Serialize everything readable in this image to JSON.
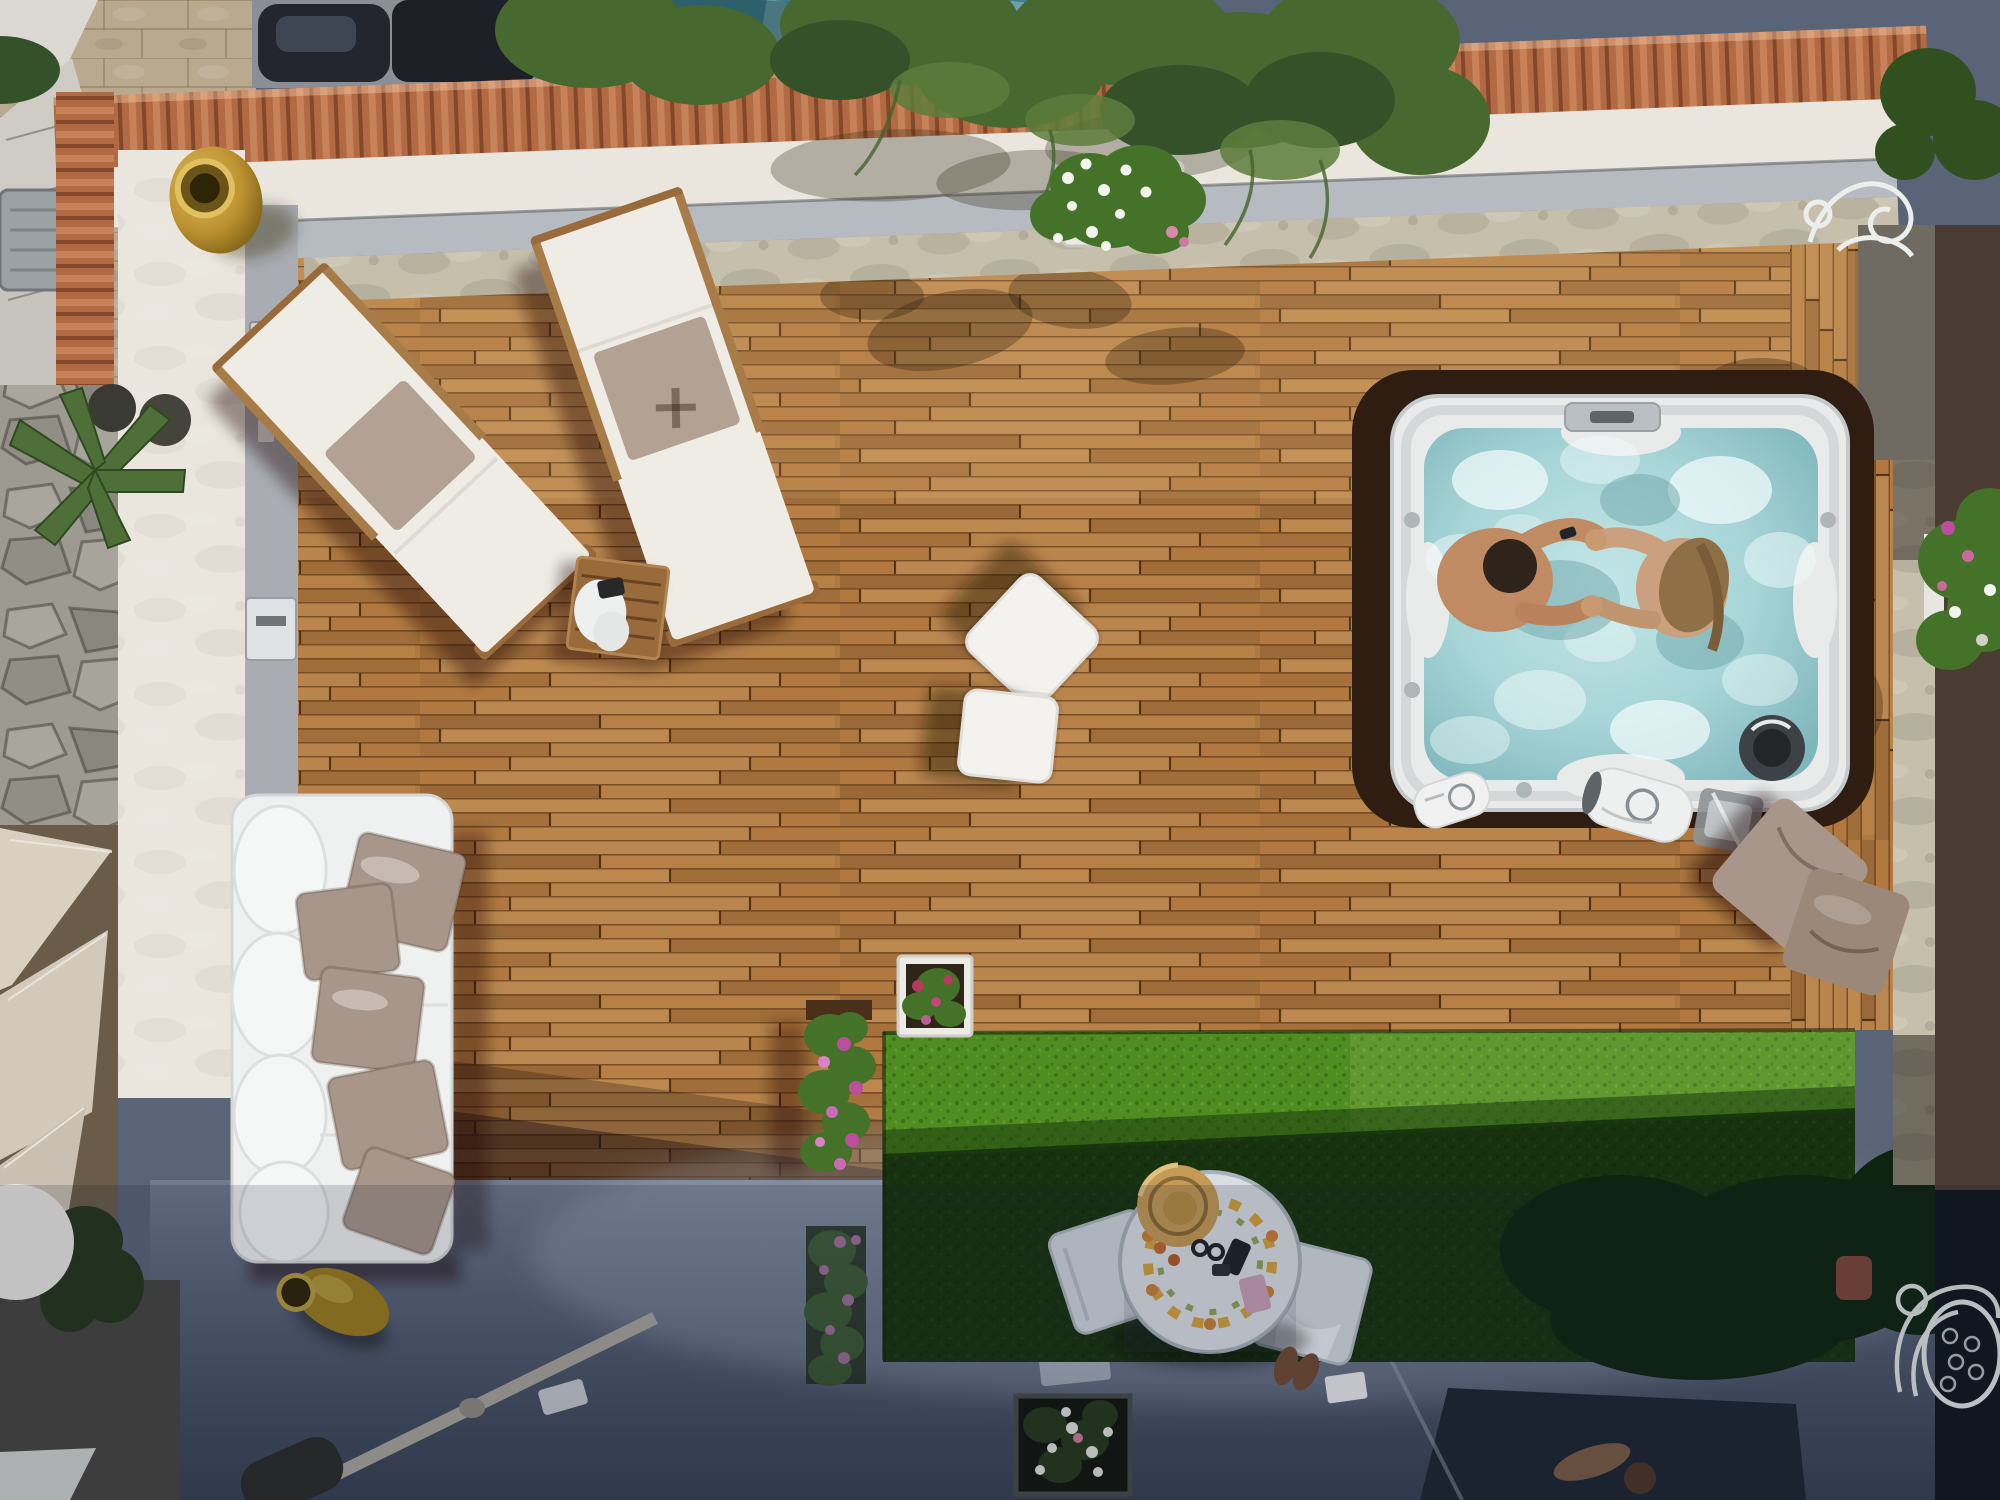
{
  "scene": {
    "type": "aerial-photo",
    "description": "Top-down drone view of a Mediterranean rooftop terrace: large hardwood deck with two sun loungers, a side table, two white pouf cubes, a white sofa with taupe pillows, a square hot tub with two bathers holding hands, flower planters, an artificial-grass strip in partial shade, and a shaded lower patio with a painted majolica round table, chairs, straw hat and sunken flower bed.",
    "objects": [
      {
        "name": "wood-deck",
        "detail": "narrow staggered hardwood planks, sunlit"
      },
      {
        "name": "sun-loungers",
        "count": 2,
        "detail": "white fabric, taupe center pillow, wooden frame, set diagonally"
      },
      {
        "name": "side-table",
        "count": 1,
        "detail": "slatted teak square table with white towels and dark item"
      },
      {
        "name": "pouf-cubes",
        "count": 2,
        "detail": "white leather cubes, one rotated 45 degrees"
      },
      {
        "name": "hot-tub",
        "count": 1,
        "detail": "white square spa, turquoise bubbling water, two people holding hands, round speaker, control panel"
      },
      {
        "name": "bathers",
        "count": 2,
        "detail": "dark-haired man and long-haired woman facing each other"
      },
      {
        "name": "sofa",
        "count": 1,
        "detail": "white outdoor sofa with five taupe cushions along left wall"
      },
      {
        "name": "amphora-jars",
        "count": 2,
        "detail": "ochre terracotta jars, one upright on parapet corner, one lying in deck shadow"
      },
      {
        "name": "flower-planters",
        "count": 5,
        "detail": "white boxes and strips of pink geraniums, white and red blooms"
      },
      {
        "name": "artificial-grass",
        "detail": "bright green strip falling into building shadow"
      },
      {
        "name": "majolica-table",
        "count": 1,
        "detail": "round white table with painted flower wreath, straw hat, sunglasses, phone"
      },
      {
        "name": "patio-chairs",
        "count": 2,
        "detail": "white chairs flanking round table, towel and brown sandals nearby"
      },
      {
        "name": "sunken-flower-bed",
        "count": 1,
        "detail": "dark planter with white blooms in shaded patio"
      },
      {
        "name": "hot-tub-pillows",
        "count": 2,
        "detail": "taupe cushions on deck corner"
      },
      {
        "name": "towel-rolls",
        "count": 2,
        "detail": "white rolled towels with logo beside hot tub"
      },
      {
        "name": "shade-sails",
        "detail": "beige triangular canopies on lower neighbour level"
      },
      {
        "name": "pine-canopy",
        "detail": "pine tree foliage overhanging terracotta coping at top"
      },
      {
        "name": "terracotta-coping",
        "detail": "ribbed roof-tile strip on perimeter wall"
      },
      {
        "name": "stone-wall",
        "detail": "rubble masonry wall and pale stone walkway on the left"
      },
      {
        "name": "wrought-iron-decor",
        "count": 2,
        "detail": "white curled iron pieces at right edge"
      }
    ]
  },
  "colors": {
    "deck_wood": "#b1793f",
    "deck_shadow": "#2f1d12",
    "parapet": "#eae6de",
    "walkway": "#b6bbc1",
    "stone": "#c6bfab",
    "terracotta": "#b26a42",
    "pavement": "#b9a98e",
    "rubble": "#9d9a91",
    "grass_sun": "#4f8d20",
    "grass_shade": "#16320e",
    "hedge": "#0e2410",
    "concrete_lo": "#465064",
    "lower_dark": "#1d2430",
    "teal_roof": "#3e7f8d",
    "car_dark": "#23262e",
    "tub_shell": "#e9ebeb",
    "tub_recess": "#43291593",
    "water": "#a7d5d8",
    "foam": "#f0f8f8",
    "sofa": "#eff1f1",
    "cushion_taupe": "#a8968a",
    "lounger_fabric": "#efece5",
    "lounger_pillow": "#b3a294",
    "wood_frame": "#996a3a",
    "pouf": "#f3f2ee",
    "amphora": "#c6a238",
    "skin": "#c08a62",
    "hair_dark": "#2f241c",
    "hair_blonde": "#8f6f46",
    "flower_pink": "#bb4f9e",
    "flower_red": "#b23b5e",
    "flower_white": "#f4f4ee",
    "foliage": "#447228",
    "pine": "#47682f",
    "sail": "#d9d0c0",
    "iron_white": "#eceeec",
    "majolica_yellow": "#d2a23c",
    "majolica_green": "#85973f",
    "hat_straw": "#c49a56",
    "table_top": "#d9dee4"
  }
}
